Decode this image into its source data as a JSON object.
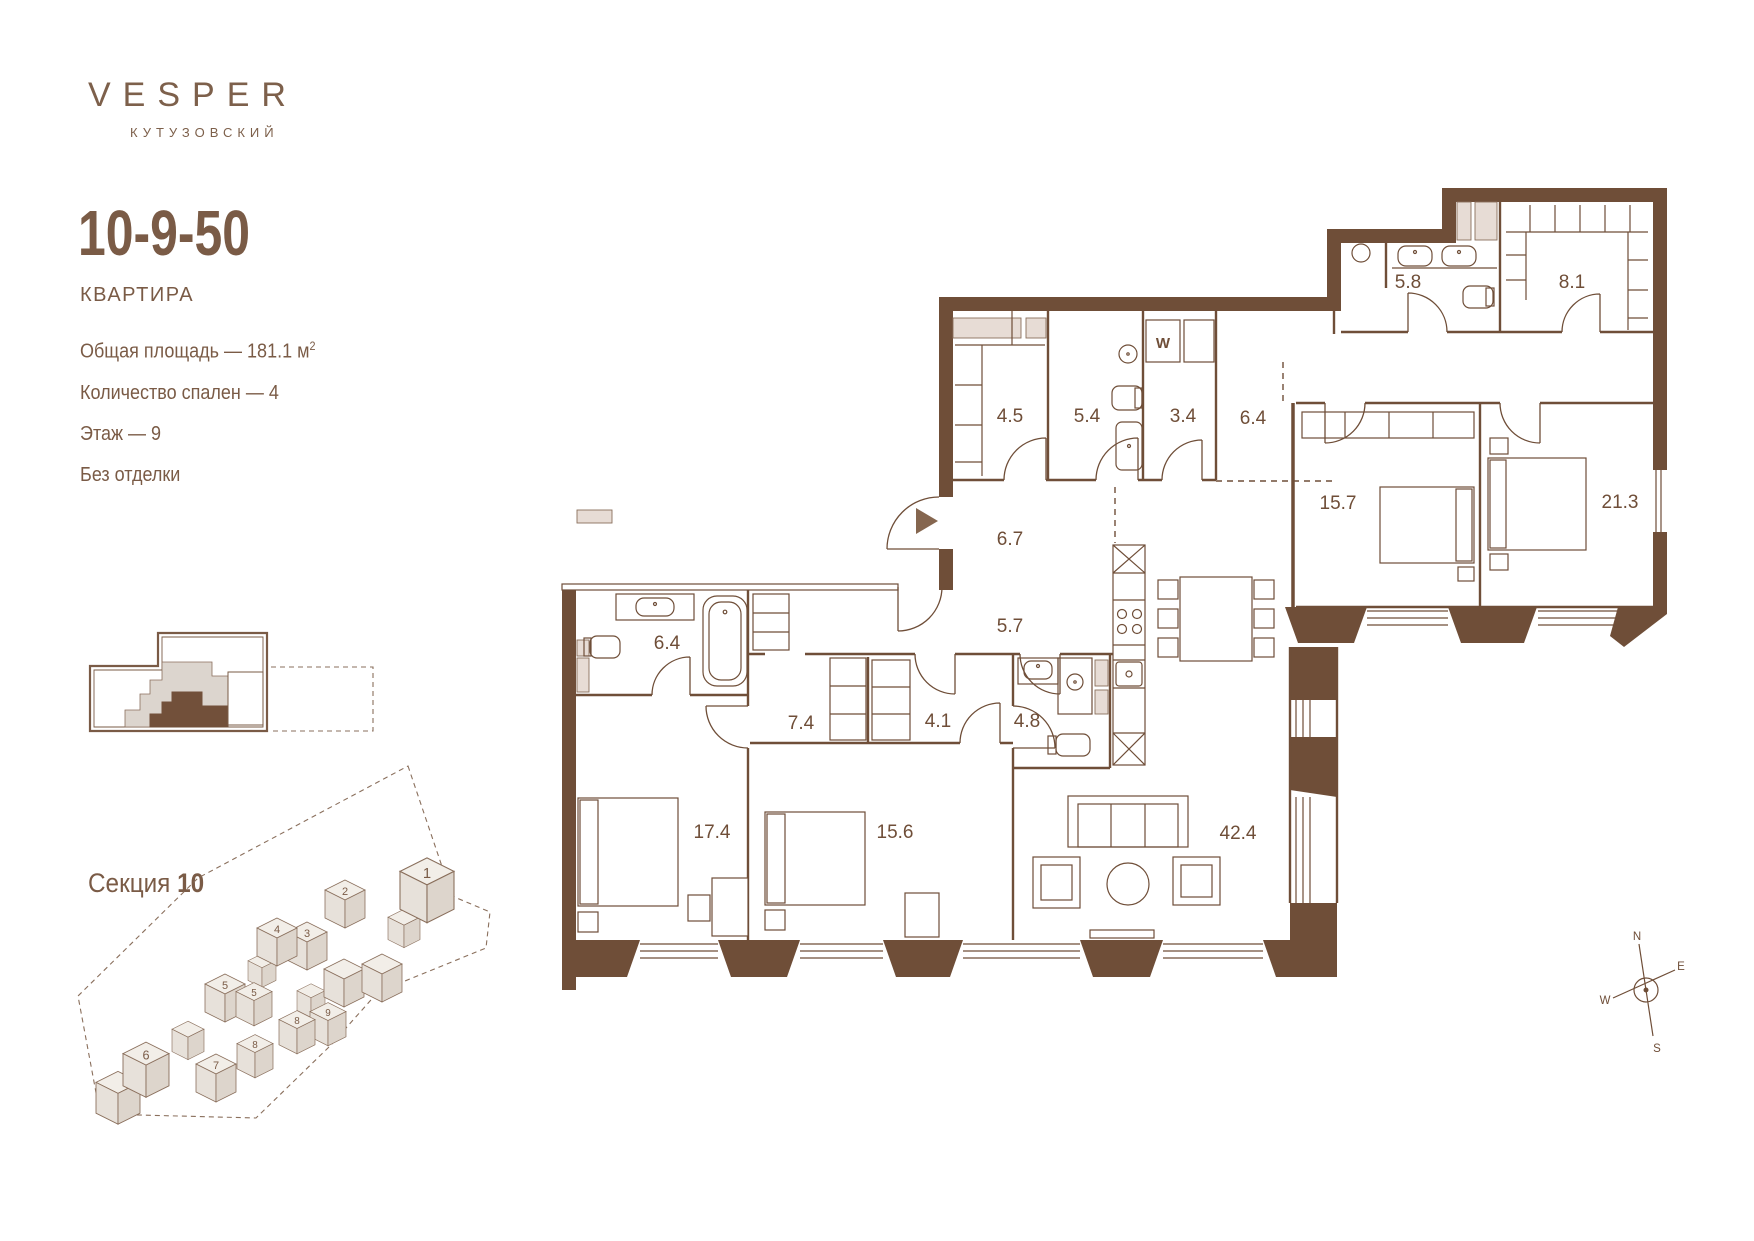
{
  "brand": {
    "name": "VESPER",
    "location": "КУТУЗОВСКИЙ"
  },
  "unit": {
    "code": "10-9-50",
    "type_label": "КВАРТИРА"
  },
  "specs": [
    {
      "text": "Общая площадь — 181.1 м",
      "sup": "2"
    },
    {
      "text": "Количество спален — 4",
      "sup": ""
    },
    {
      "text": "Этаж — 9",
      "sup": ""
    },
    {
      "text": "Без отделки",
      "sup": ""
    }
  ],
  "section": {
    "label": "Секция",
    "value": "10"
  },
  "site_plan": {
    "buildings": [
      {
        "label": "1"
      },
      {
        "label": "2"
      },
      {
        "label": "3"
      },
      {
        "label": "4"
      },
      {
        "label": "5"
      },
      {
        "label": "5"
      },
      {
        "label": "10",
        "highlighted": true
      },
      {
        "label": "10",
        "highlighted": true
      },
      {
        "label": "9"
      },
      {
        "label": "8"
      },
      {
        "label": "8"
      },
      {
        "label": "7"
      },
      {
        "label": "6"
      }
    ]
  },
  "plan": {
    "rooms": {
      "bath_small": "5.8",
      "dressing": "8.1",
      "wardrobe_entry": "4.5",
      "bath_guest": "5.4",
      "wc": "3.4",
      "corridor_top": "6.4",
      "bedroom_2": "15.7",
      "bedroom_master": "21.3",
      "hall": "6.7",
      "corridor_mid": "5.7",
      "bath_master": "6.4",
      "wardrobe_1": "7.4",
      "wardrobe_2": "4.1",
      "bath_3": "4.8",
      "bedroom_3": "17.4",
      "bedroom_4": "15.6",
      "living": "42.4"
    },
    "washer": "W"
  },
  "compass": {
    "n": "N",
    "e": "E",
    "s": "S",
    "w": "W"
  },
  "colors": {
    "wall": "#6F4E38",
    "text": "#7A5B46",
    "shaft": "#E7DCD5",
    "site_building": "#EDE8E2",
    "site_highlight": "#72503A"
  }
}
